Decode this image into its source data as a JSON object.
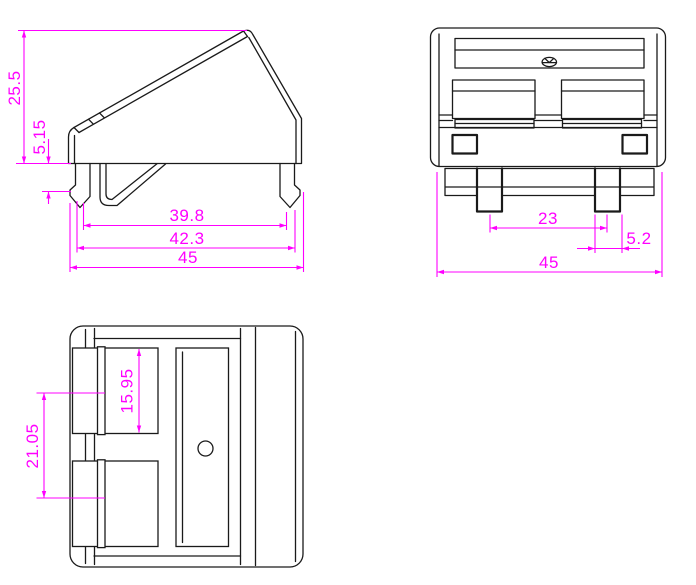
{
  "drawing": {
    "kind": "engineering-drawing-three-views",
    "background_color": "#ffffff",
    "part_line_color": "#1a1a1a",
    "dimension_color": "#ff00ff",
    "views": {
      "side": {
        "label": "side-profile-view",
        "dims": {
          "total_height": "25.5",
          "clip_height": "5.15",
          "inner_width": "39.8",
          "mid_width": "42.3",
          "total_width": "45"
        }
      },
      "front": {
        "label": "front-view",
        "dims": {
          "leg_spacing": "23",
          "leg_offset": "5.2",
          "total_width": "45"
        }
      },
      "bottom": {
        "label": "bottom-view",
        "dims": {
          "window_height": "15.95",
          "window_spacing": "21.05"
        }
      }
    }
  }
}
